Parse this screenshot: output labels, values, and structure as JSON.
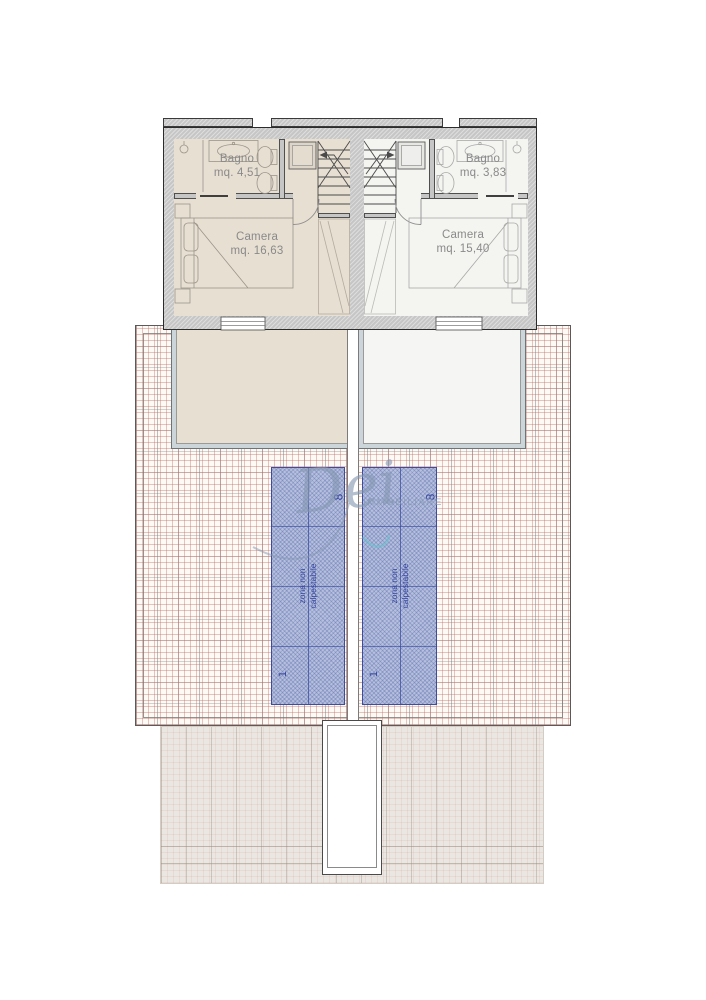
{
  "watermark": {
    "script": "Dei",
    "caps": "IMMOBILIARE"
  },
  "units": [
    {
      "bathroom": {
        "label": "Bagno",
        "area": "mq. 4,51"
      },
      "bedroom": {
        "label": "Camera",
        "area": "mq. 16,63"
      }
    },
    {
      "bathroom": {
        "label": "Bagno",
        "area": "mq. 3,83"
      },
      "bedroom": {
        "label": "Camera",
        "area": "mq. 15,40"
      }
    }
  ],
  "roof_zones": [
    {
      "top_number": "8",
      "label": "zona non calpestabile",
      "bottom_number": "1"
    },
    {
      "top_number": "8",
      "label": "zona non calpestabile",
      "bottom_number": "1"
    }
  ],
  "colors": {
    "bedroom_left_fill": "#e7dfd2",
    "bedroom_right_fill": "#f4f4f1",
    "wall_gray": "#c6c6c6",
    "roof_hatch_red": "#c46e64",
    "zone_fill": "#b6c0de",
    "zone_line": "#3c4da0",
    "terrace_band": "#ccd5d9",
    "watermark_blue": "#8496b2"
  }
}
